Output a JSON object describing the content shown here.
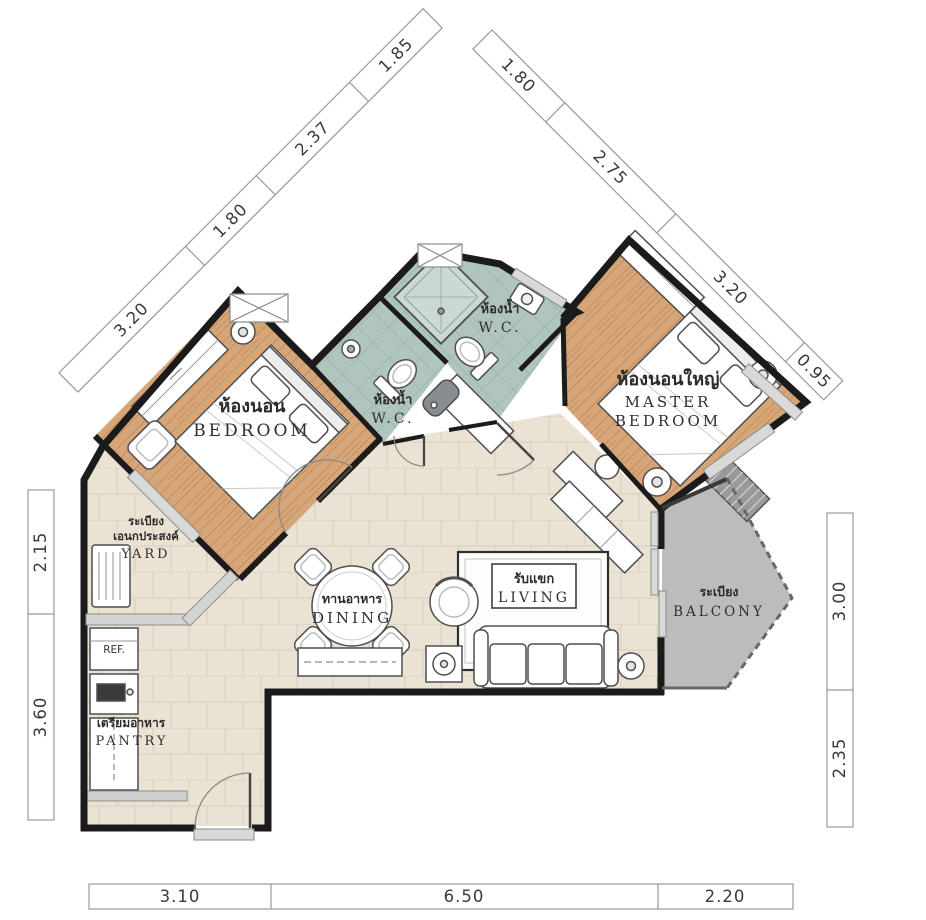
{
  "page": {
    "description": "Condominium unit floor plan (2 bedroom) with Thai and English room labels and dimension strips in meters"
  },
  "colors": {
    "wall": "#1b1b1b",
    "wood_floor": "#d6a678",
    "wood_grain": "#c18f5f",
    "bath_floor": "#afc5be",
    "bath_grid": "#92aca4",
    "tile_floor": "#eae3d4",
    "tile_grid": "#d8cfba",
    "balcony_floor": "#bcbcbc",
    "sill_gray": "#d9d9d9",
    "dim_line": "#9a9a9a",
    "dim_text": "#3a3a3a",
    "label_text": "#2b2b2b"
  },
  "rooms": {
    "bedroom": {
      "th": "ห้องนอน",
      "en": "BEDROOM"
    },
    "master_bedroom": {
      "th": "ห้องนอนใหญ่",
      "en1": "MASTER",
      "en2": "BEDROOM"
    },
    "wc_main": {
      "th": "ห้องน้ำ",
      "en": "W.C."
    },
    "wc_small": {
      "th": "ห้องน้ำ",
      "en": "W.C."
    },
    "dining": {
      "th": "ทานอาหาร",
      "en": "DINING"
    },
    "living": {
      "th": "รับแขก",
      "en": "LIVING"
    },
    "yard": {
      "th1": "ระเบียง",
      "th2": "เอนกประสงค์",
      "en": "YARD"
    },
    "pantry": {
      "th": "เตรียมอาหาร",
      "en": "PANTRY"
    },
    "balcony": {
      "th": "ระเบียง",
      "en": "BALCONY"
    },
    "refrigerator": "REF."
  },
  "dimensions_m": {
    "top_left_diagonal": [
      "3.20",
      "1.80",
      "2.37",
      "1.85"
    ],
    "top_right_diagonal": [
      "1.80",
      "2.75",
      "3.20",
      "0.95"
    ],
    "left_side": [
      "2.15",
      "3.60"
    ],
    "right_side": [
      "3.00",
      "2.35"
    ],
    "bottom": [
      "3.10",
      "6.50",
      "2.20"
    ]
  }
}
